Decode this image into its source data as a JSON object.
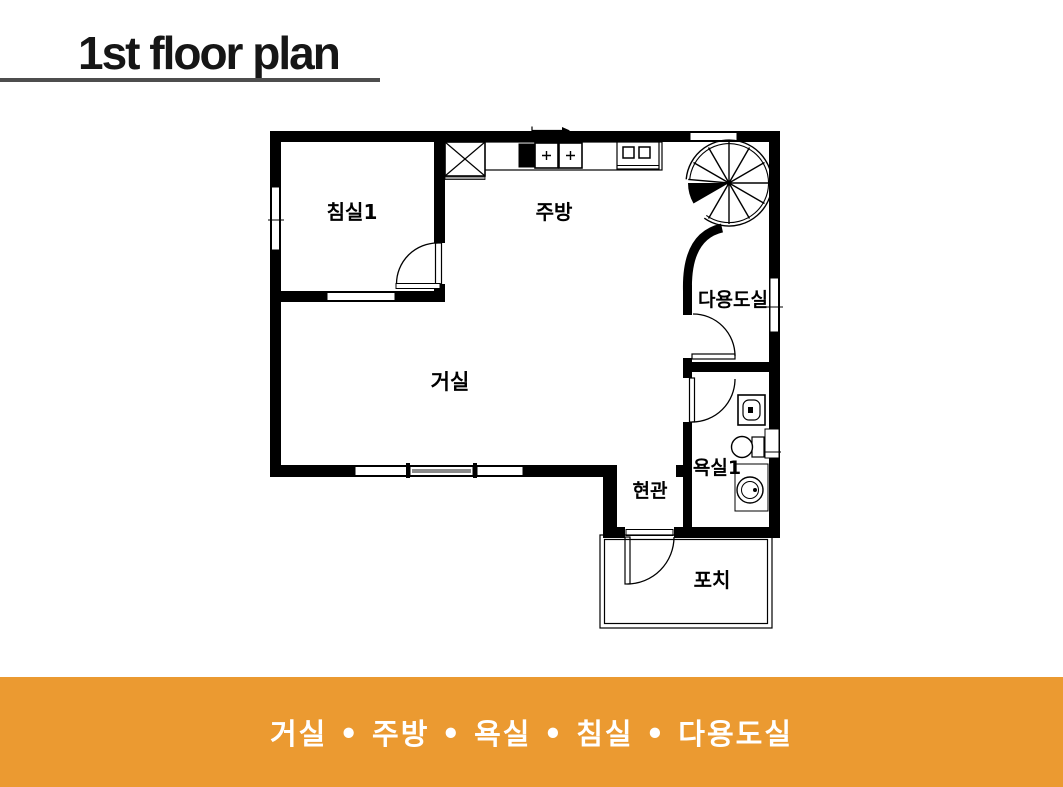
{
  "header": {
    "title": "1st floor plan",
    "title_color": "#161616",
    "underline_color": "#4d4d4d"
  },
  "plan": {
    "wall_color": "#000000",
    "line_color": "#000000",
    "floor_color": "#ffffff",
    "rooms": [
      {
        "id": "bedroom1",
        "label": "침실1"
      },
      {
        "id": "kitchen",
        "label": "주방"
      },
      {
        "id": "utility",
        "label": "다용도실"
      },
      {
        "id": "living",
        "label": "거실"
      },
      {
        "id": "entrance",
        "label": "현관"
      },
      {
        "id": "bathroom1",
        "label": "욕실1"
      },
      {
        "id": "porch",
        "label": "포치"
      }
    ],
    "fixtures": [
      "refrigerator",
      "kitchen-sink",
      "stove",
      "spiral-staircase",
      "bathroom-sink",
      "toilet",
      "wash-basin"
    ]
  },
  "banner": {
    "background": "#EB9A31",
    "text_color": "#ffffff",
    "separator": "•",
    "items": [
      "거실",
      "주방",
      "욕실",
      "침실",
      "다용도실"
    ],
    "text": "거실 • 주방 • 욕실 • 침실 • 다용도실"
  }
}
